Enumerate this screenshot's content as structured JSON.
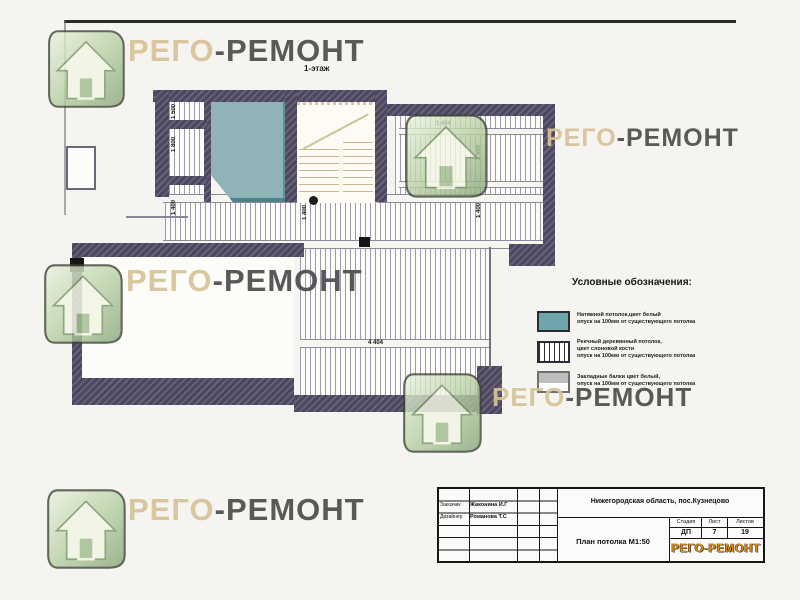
{
  "sheet": {
    "floor_label": "1-этаж"
  },
  "watermark": {
    "left": "РЕГО",
    "right": "-РЕМОНТ"
  },
  "plan": {
    "dims": [
      {
        "t": "1 500"
      },
      {
        "t": "1 800"
      },
      {
        "t": "1 400"
      },
      {
        "t": "1 400"
      },
      {
        "t": "1 500"
      },
      {
        "t": "1 400"
      },
      {
        "t": "1 404"
      },
      {
        "t": "4 404"
      }
    ]
  },
  "legend": {
    "title": "Условные обозначения:",
    "items": [
      {
        "swatch": "stretch-ceiling",
        "lines": [
          "Натяжной потолок,цвет белый",
          "опуск на 100мм от существующего потолка"
        ]
      },
      {
        "swatch": "wood-slat-ceiling",
        "lines": [
          "Реечный деревянный потолок,",
          "цвет слоновой кости",
          "опуск на 100мм от существующего потолка"
        ]
      },
      {
        "swatch": "inset-beams",
        "lines": [
          "Закладные балки цвет белый,",
          "опуск на 100мм от существующего потолка"
        ]
      }
    ]
  },
  "titleblock": {
    "region": "Нижегородская область, пос.Кузнецово",
    "people": [
      {
        "role": "Заказчик",
        "name": "Жаконина И.Г"
      },
      {
        "role": "Дизайнер",
        "name": "Романова Т.С"
      }
    ],
    "stage_headers": [
      "Стадия",
      "Лист",
      "Листов"
    ],
    "stage_values": [
      "ДП",
      "7",
      "19"
    ],
    "doc_title": "План потолка М1:50",
    "logo_left": "РЕГО",
    "logo_right": "-РЕМОНТ"
  },
  "colors": {
    "wall": "#4d4760",
    "stretch_teal": "#8fb3b6",
    "house_green": "#b9d1a6",
    "brand_beige": "#d7c398",
    "brand_dark": "#4c4c4c",
    "logo_orange": "#d98f1f"
  }
}
